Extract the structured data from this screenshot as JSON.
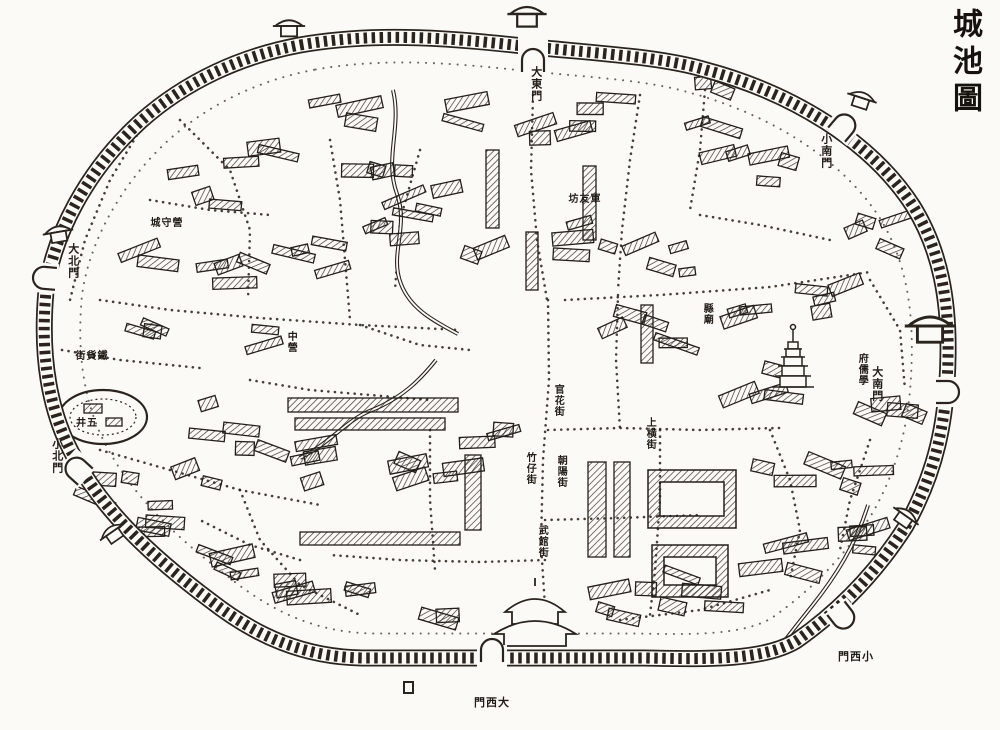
{
  "title": {
    "text": "城池圖"
  },
  "map": {
    "paper_color": "#fbfaf7",
    "ink_color": "#2b241e",
    "gates": [
      {
        "id": "great-east-gate",
        "text": "大東門",
        "orientation": "vertical",
        "x": 536,
        "y": 66
      },
      {
        "id": "great-west-gate",
        "text": "門西大",
        "orientation": "horizontal",
        "x": 492,
        "y": 703
      },
      {
        "id": "great-south-gate",
        "text": "大南門",
        "orientation": "vertical",
        "x": 877,
        "y": 366
      },
      {
        "id": "great-north-gate",
        "text": "大北門",
        "orientation": "vertical",
        "x": 73,
        "y": 243
      },
      {
        "id": "small-north-gate",
        "text": "小北門",
        "orientation": "vertical",
        "x": 57,
        "y": 438
      },
      {
        "id": "small-west-gate",
        "text": "門西小",
        "orientation": "horizontal",
        "x": 856,
        "y": 657
      },
      {
        "id": "small-south-gate",
        "text": "小南門",
        "orientation": "vertical",
        "x": 826,
        "y": 133
      }
    ],
    "labels": [
      {
        "id": "prefectural-confucian-school",
        "text": "府儒學",
        "orientation": "vertical",
        "x": 861,
        "y": 353
      },
      {
        "id": "junyou-archway",
        "text": "坊友軍",
        "orientation": "horizontal",
        "x": 585,
        "y": 200
      },
      {
        "id": "city-guard-camp",
        "text": "城守營",
        "orientation": "horizontal",
        "x": 167,
        "y": 224
      },
      {
        "id": "ironware-street",
        "text": "街貨鐵",
        "orientation": "horizontal",
        "x": 92,
        "y": 357
      },
      {
        "id": "five-wells",
        "text": "井五",
        "orientation": "horizontal",
        "x": 87,
        "y": 424
      },
      {
        "id": "upper-cross-street",
        "text": "上横街",
        "orientation": "vertical",
        "x": 649,
        "y": 417
      },
      {
        "id": "guanhua-street",
        "text": "官花街",
        "orientation": "vertical",
        "x": 557,
        "y": 384
      },
      {
        "id": "zhuzai-street",
        "text": "竹仔街",
        "orientation": "vertical",
        "x": 529,
        "y": 452
      },
      {
        "id": "chaoyang-street",
        "text": "朝陽街",
        "orientation": "vertical",
        "x": 560,
        "y": 455
      },
      {
        "id": "wuguan-street",
        "text": "武館街",
        "orientation": "vertical",
        "x": 541,
        "y": 525
      },
      {
        "id": "county-temple",
        "text": "縣廟",
        "orientation": "vertical",
        "x": 706,
        "y": 303
      },
      {
        "id": "middle-camp",
        "text": "中營",
        "orientation": "vertical",
        "x": 290,
        "y": 331
      }
    ]
  }
}
